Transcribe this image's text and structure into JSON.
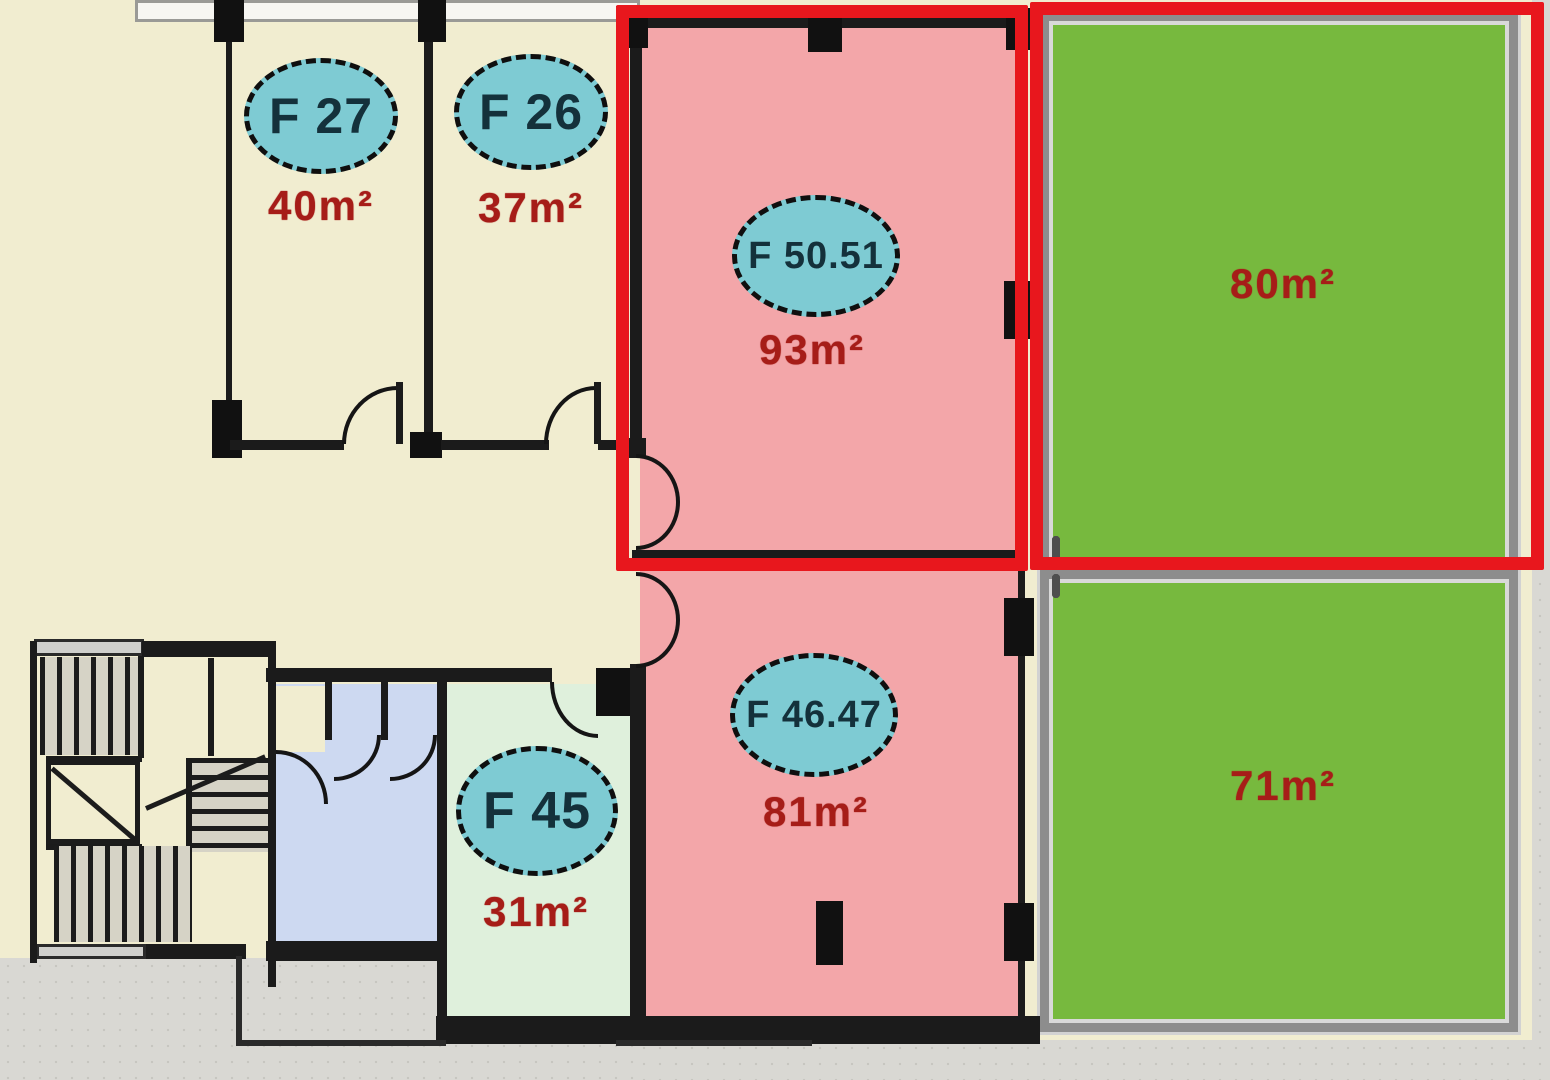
{
  "plan": {
    "rooms": {
      "f27": {
        "label": "F 27",
        "area": "40m²"
      },
      "f26": {
        "label": "F 26",
        "area": "37m²"
      },
      "f5051": {
        "label": "F 50.51",
        "area": "93m²"
      },
      "f45": {
        "label": "F 45",
        "area": "31m²"
      },
      "f4647": {
        "label": "F 46.47",
        "area": "81m²"
      },
      "green80": {
        "area": "80m²"
      },
      "green71": {
        "area": "71m²"
      }
    },
    "colors": {
      "selection_outline": "#e8171d",
      "badge_fill": "#7ecbd3",
      "badge_text": "#14313b",
      "area_text": "#a61d18",
      "room_green": "#77b93e",
      "room_pink": "#f3a6a9",
      "room_beige": "#f1edd0",
      "room_mint": "#dff0dc",
      "room_blue": "#cdd9f1",
      "wall": "#1b1b1b"
    }
  }
}
